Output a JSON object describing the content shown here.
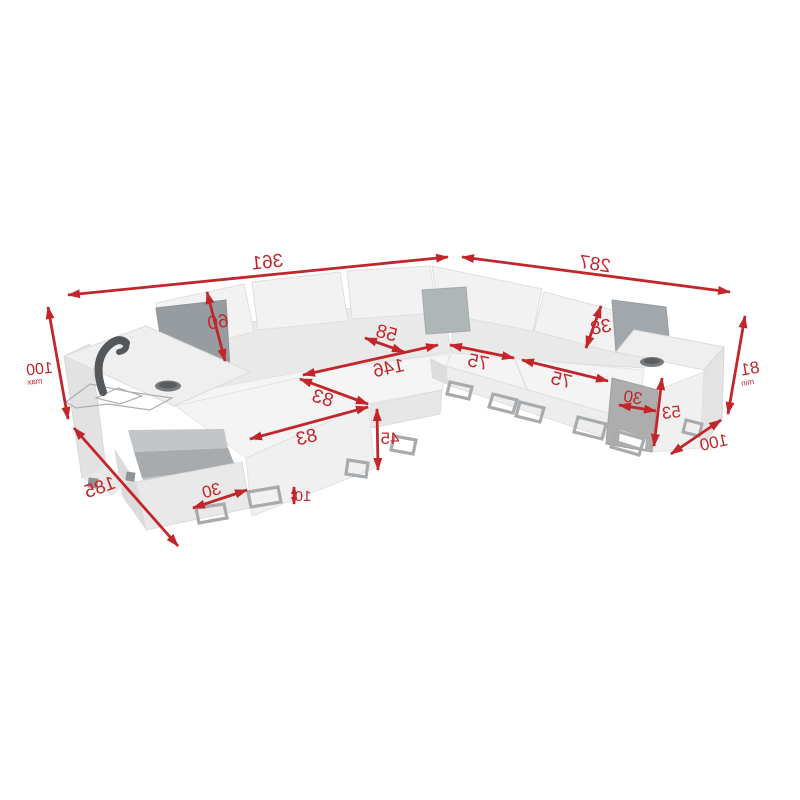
{
  "diagram": {
    "kind": "furniture-dimension-diagram",
    "subject": "U-shaped corner sofa with open storage, adjustable headrests, cup holders and reading lamp",
    "text_mirrored": true,
    "accent_color": "#C2262B",
    "sofa_palette": {
      "body_light": "#F3F3F3",
      "body_mid": "#E9E9E9",
      "body_shadow": "#DCDCDC",
      "pillow_dark": "#979CA0",
      "storage_interior": "#A7ABAE",
      "armrest_front_dark": "#ADADAD",
      "metal_leg": "#A8ABAD"
    },
    "dims": {
      "total_width_left": {
        "value": "361"
      },
      "total_width_right": {
        "value": "287"
      },
      "max_height": {
        "value": "100",
        "suffix": "max"
      },
      "backrest_height": {
        "value": "60"
      },
      "headrest_height": {
        "value": "38"
      },
      "seat_depth": {
        "value": "58"
      },
      "inner_length": {
        "value": "146"
      },
      "seat_width_a": {
        "value": "75"
      },
      "seat_width_b": {
        "value": "75"
      },
      "chaise_length_a": {
        "value": "83"
      },
      "chaise_length_b": {
        "value": "83"
      },
      "seat_height": {
        "value": "45"
      },
      "total_depth_left": {
        "value": "185"
      },
      "storage_depth": {
        "value": "30"
      },
      "leg_height": {
        "value": "10"
      },
      "armrest_width": {
        "value": "30"
      },
      "armrest_height": {
        "value": "53"
      },
      "min_height": {
        "value": "81",
        "suffix": "min"
      },
      "total_depth_right": {
        "value": "100"
      }
    }
  }
}
